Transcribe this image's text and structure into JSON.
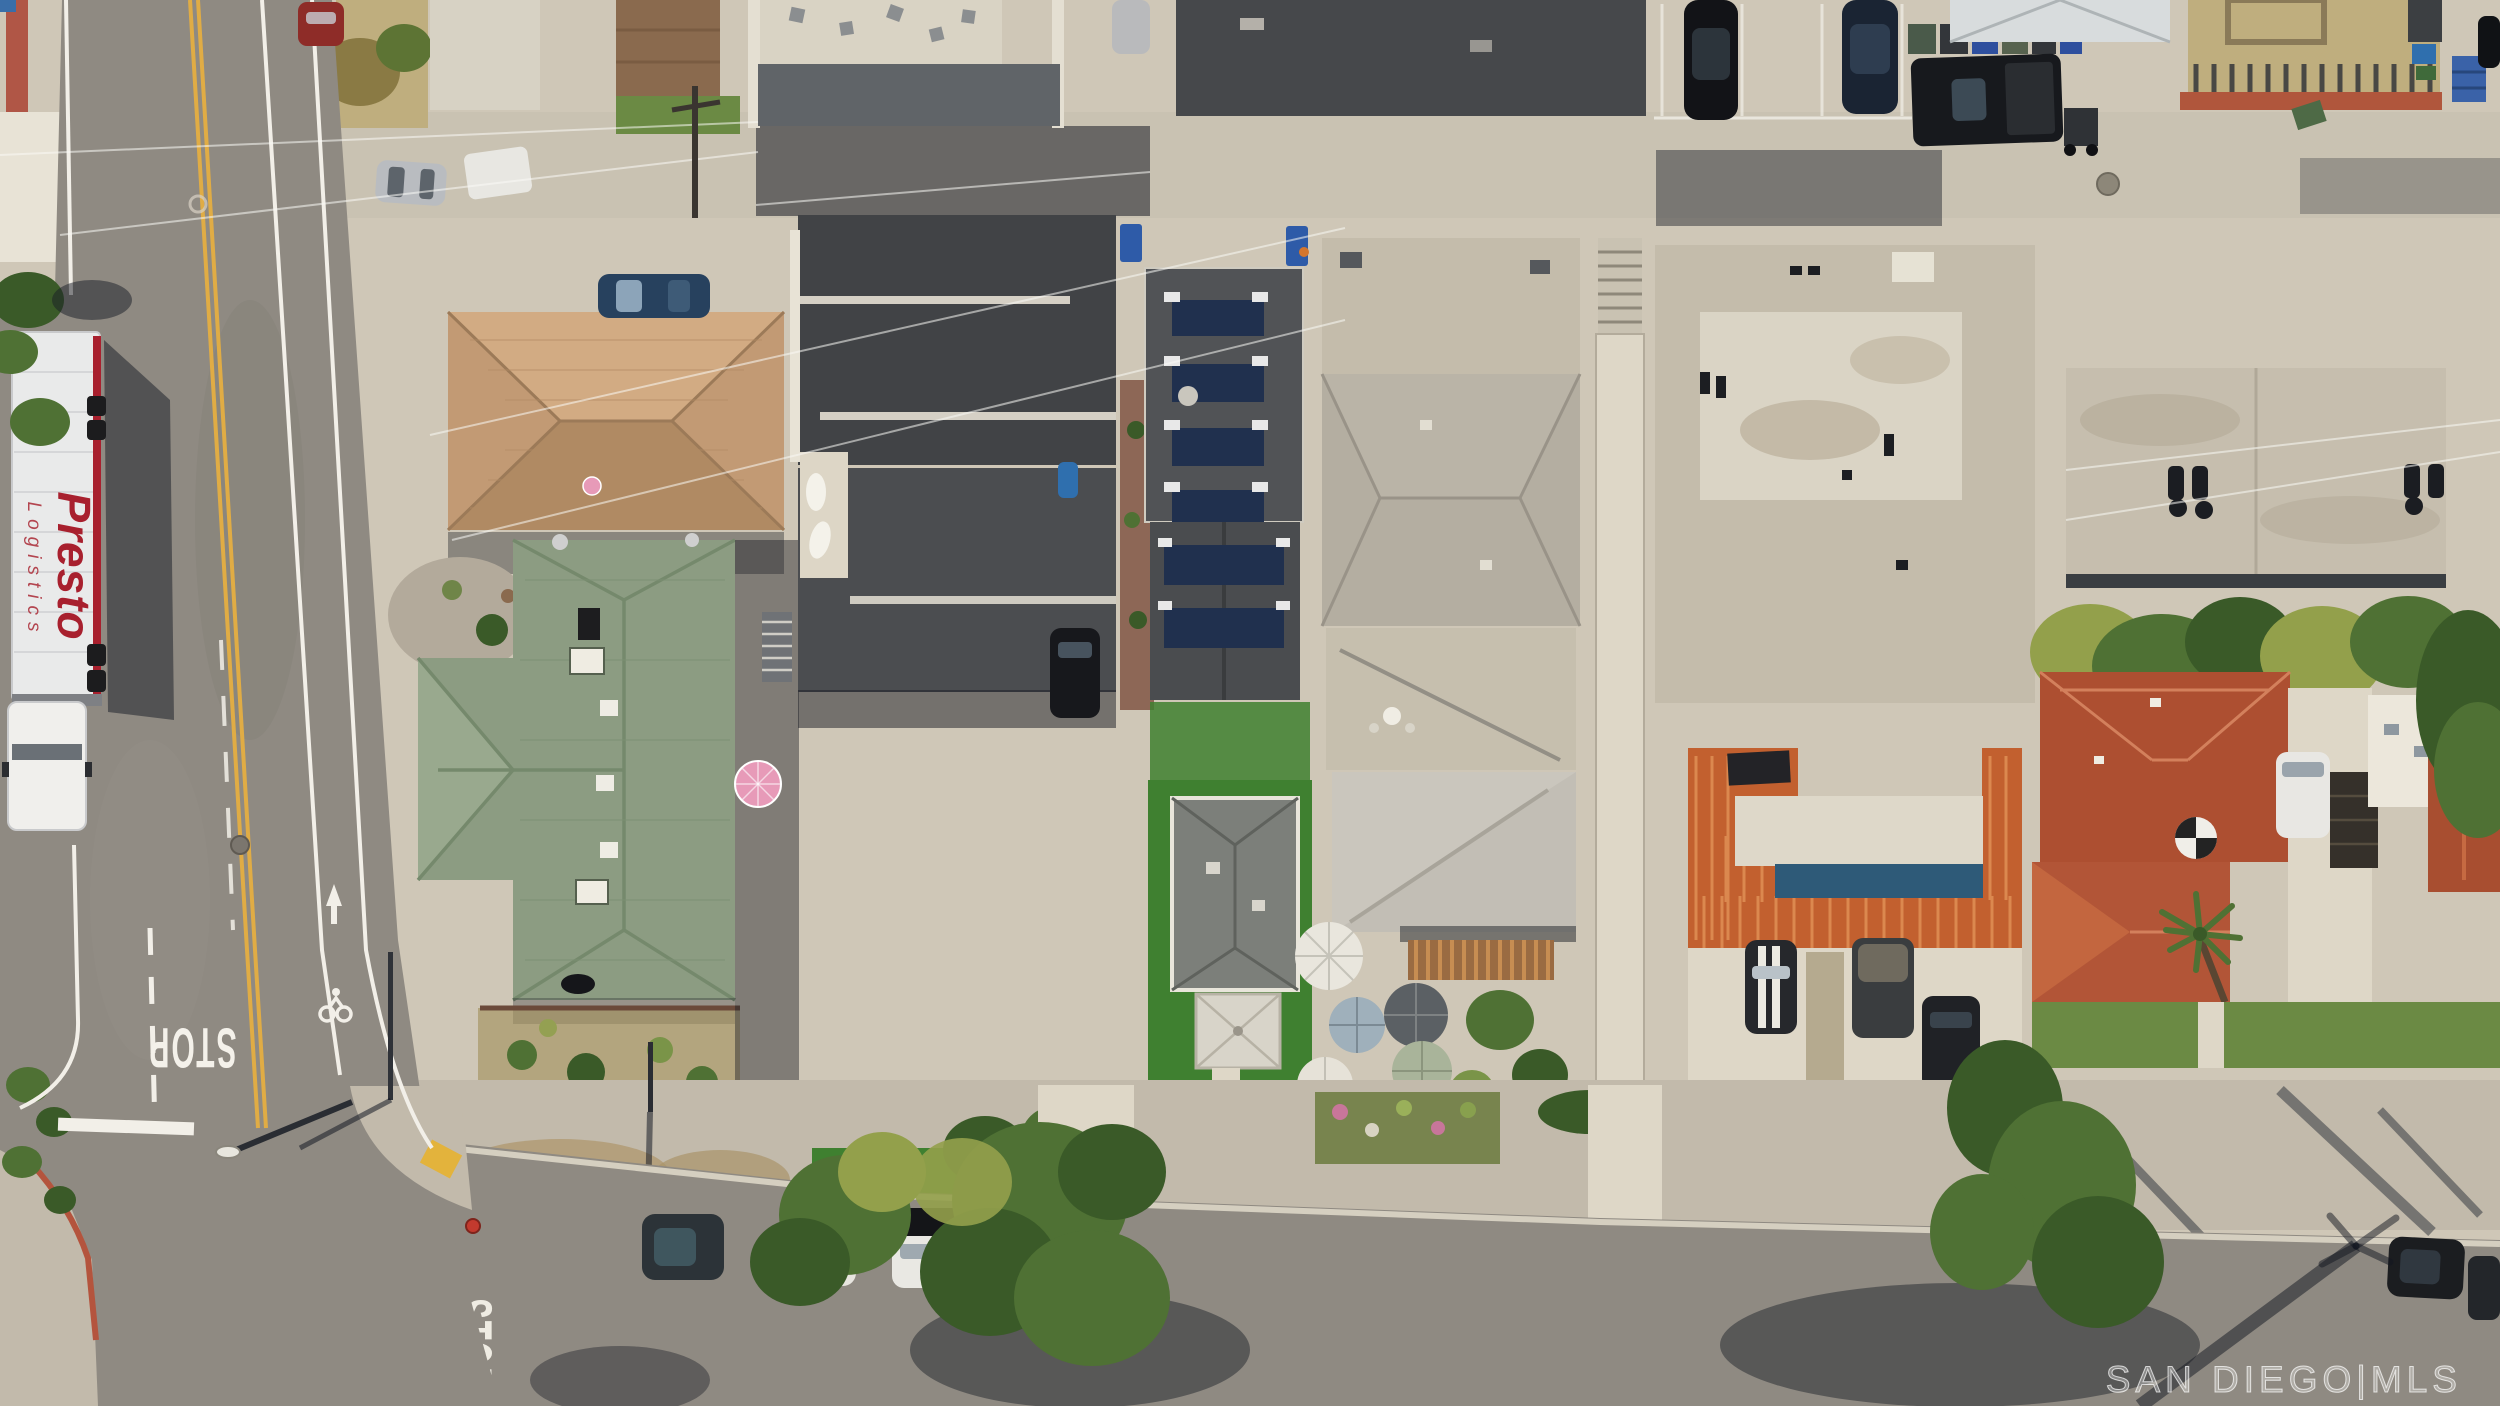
{
  "image": {
    "title": "Aerial drone view of a residential block",
    "width": 2500,
    "height": 1406,
    "description": "Top-down aerial photo of a San Diego residential block: vertical street at left with STOP marking and bike lane, parked Presto Logistics semi truck, block of homes with green, tan, charcoal, gray and terracotta tile roofs, rooftop solar panels, patio umbrellas, trees, parked cars, and a bottom street with STOP marking and tree shadows."
  },
  "watermark": {
    "text": "SAN DIEGO|MLS",
    "color": "#ffffff"
  },
  "road_markings": {
    "stop_left_street": "STOP",
    "stop_bottom_street": "STOP"
  },
  "truck": {
    "line1": "Presto",
    "line2": "Logistics",
    "text_color": "#a8202e"
  },
  "objects": [
    "semi-truck-presto-logistics",
    "stop-road-marking-left",
    "stop-road-marking-bottom",
    "bike-lane-symbol",
    "double-yellow-center-line",
    "green-shingle-roof-house",
    "tan-shingle-roof-house",
    "charcoal-flat-roof-buildings",
    "solar-panel-roof",
    "gray-hip-roof-cottage",
    "white-gazebo",
    "patio-umbrellas",
    "pink-umbrella",
    "spanish-tile-roof-complex",
    "weathered-flat-roofs",
    "terracotta-roof-house",
    "street-trees",
    "palm-trees",
    "parked-cars",
    "trash-bins",
    "fire-hydrant",
    "street-light",
    "power-lines",
    "mls-watermark"
  ],
  "palette": {
    "asphalt": "#8f8a82",
    "asphalt2": "#86817a",
    "concrete": "#cfc7b7",
    "concrete_bright": "#ded7c7",
    "concrete_dim": "#c2baab",
    "alley": "#c9c2b2",
    "shadow": "rgba(22,26,36,0.5)",
    "roof_tan": "#c29a74",
    "roof_green": "#8c9c82",
    "roof_charcoal": "#414346",
    "roof_charcoal2": "#4b4d50",
    "roof_gray": "#b4aea1",
    "roof_gray2": "#c2beb5",
    "roof_weathered": "#c4bcab",
    "roof_white": "#ded8c9",
    "tile_orange": "#c2602f",
    "tile_red": "#ad4f31",
    "solar": "#20304e",
    "turf": "#3f8030",
    "lawn": "#6b8a44",
    "dry_grass": "#bfae7e",
    "dirt": "#b09a72",
    "tree": "#4f7134",
    "tree_dark": "#3a5a28",
    "tree_yellow": "#93a04b",
    "yellow_line": "#e0ac45",
    "white_line": "#f2efe8",
    "truck_body": "#e9eaea",
    "truck_red": "#a8202e",
    "blue_stripe": "#2e5a78",
    "water_blue": "#2f6fae",
    "pink": "#e79ab8"
  }
}
